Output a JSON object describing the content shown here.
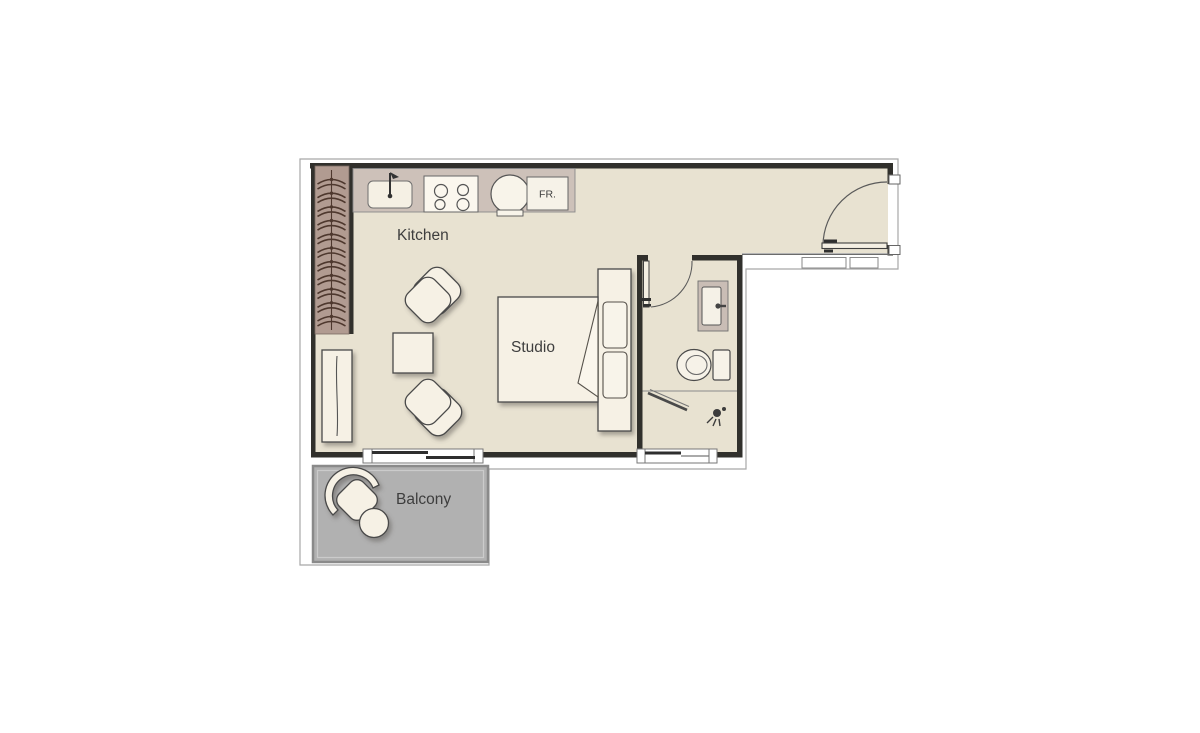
{
  "plan": {
    "labels": {
      "kitchen": "Kitchen",
      "studio": "Studio",
      "balcony": "Balcony",
      "fridge": "FR."
    },
    "colors": {
      "background": "#ffffff",
      "floor": "#e8e2d1",
      "wall": "#31302c",
      "boundary_line": "#a8a8a8",
      "counter": "#cdc1b9",
      "wardrobe": "#b19b91",
      "hanger": "#4e382e",
      "vanity": "#c9bdb5",
      "balcony_floor": "#b1b1b1",
      "balcony_border": "#8a8a8a",
      "furniture": "#f6f1e5",
      "fixture_white": "#f8f4ea",
      "label_text": "#3e3e3e"
    }
  }
}
